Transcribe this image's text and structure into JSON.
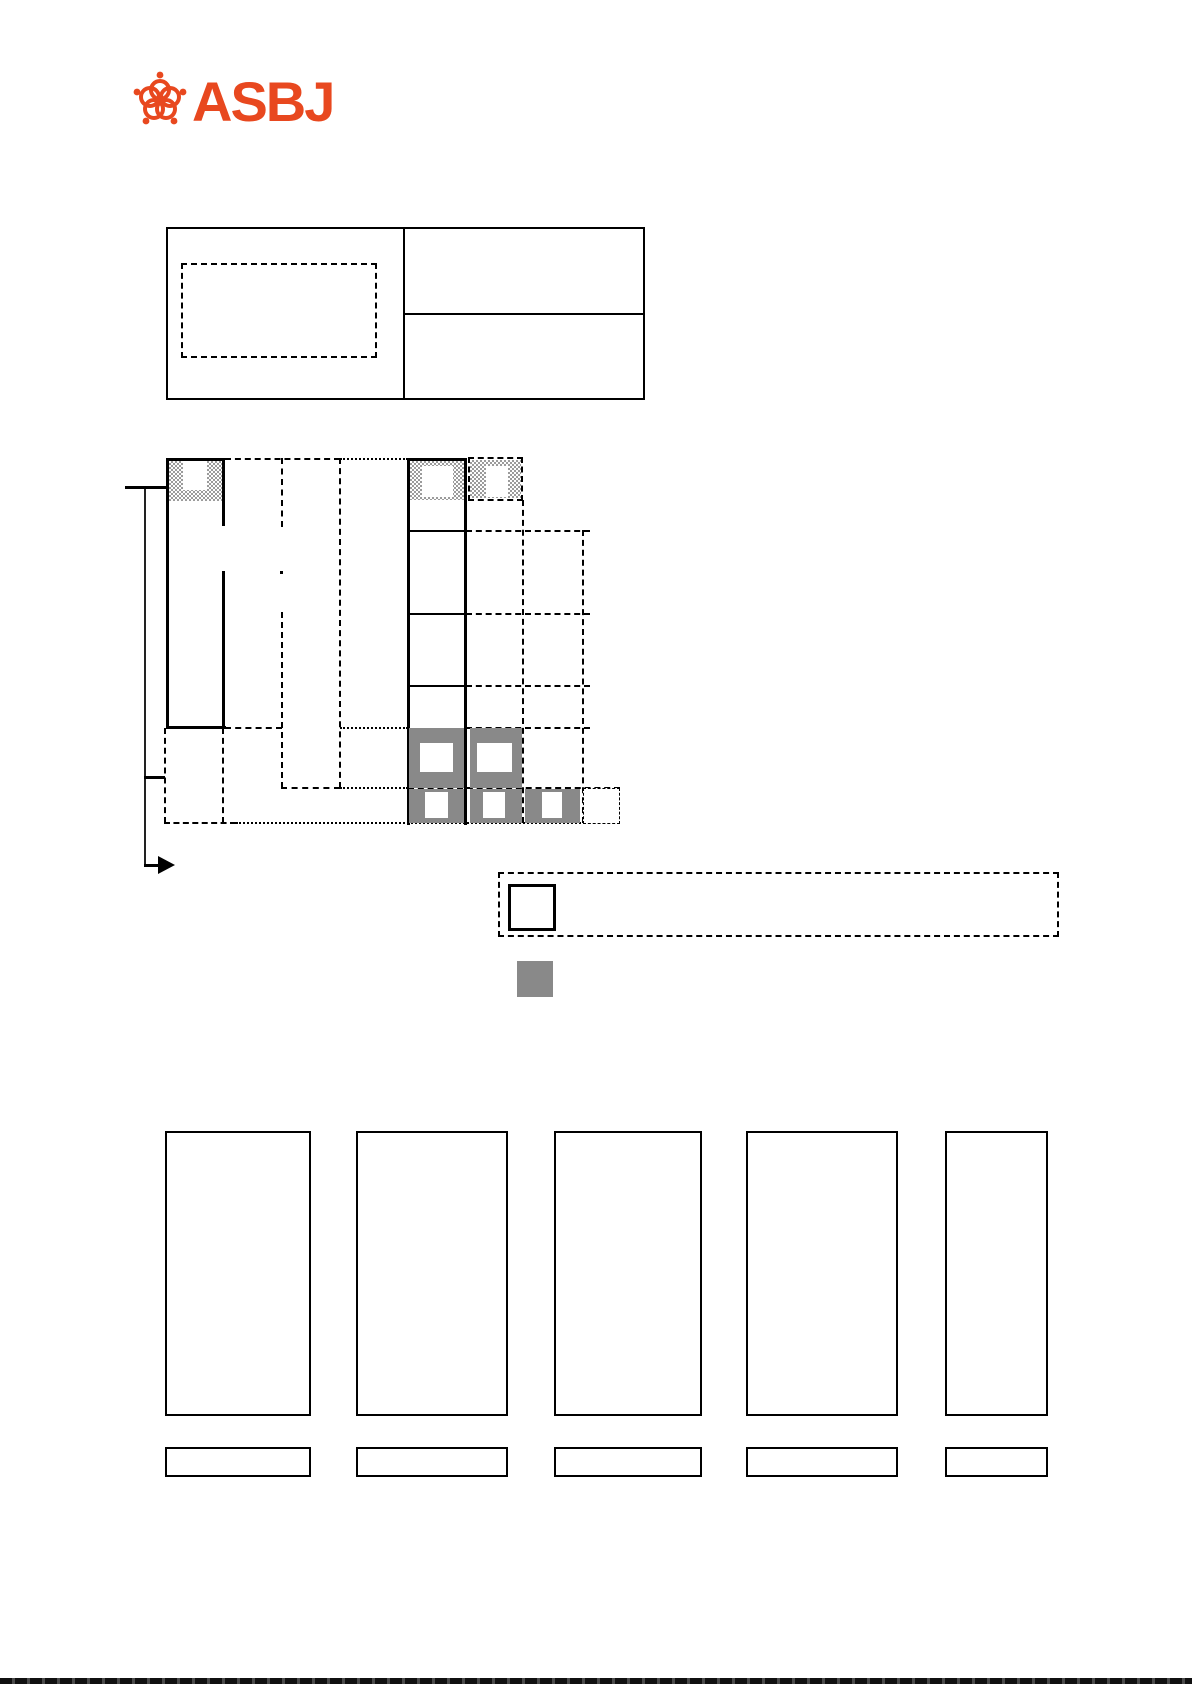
{
  "logo": {
    "text": "ASBJ",
    "emblem": "plum-blossom-icon"
  },
  "colors": {
    "accent": "#e8481f",
    "gray": "#898989",
    "line": "#000000"
  },
  "document": {
    "kind": "figure-only page (no body text visible)",
    "sections": {
      "header_table": {
        "cells": 3,
        "placeholder_dashed_boxes": 1,
        "visible_text": ""
      },
      "timeline_diagram": {
        "hatched_headers": 3,
        "gray_blocks": 5,
        "dashed_grid_rows": 6,
        "visible_text": ""
      },
      "legend": {
        "outline_swatch": "white square",
        "gray_swatch": "gray square",
        "visible_text": ""
      },
      "appendix_columns": {
        "count": 5,
        "caption_boxes": 5,
        "visible_text": ""
      }
    }
  }
}
